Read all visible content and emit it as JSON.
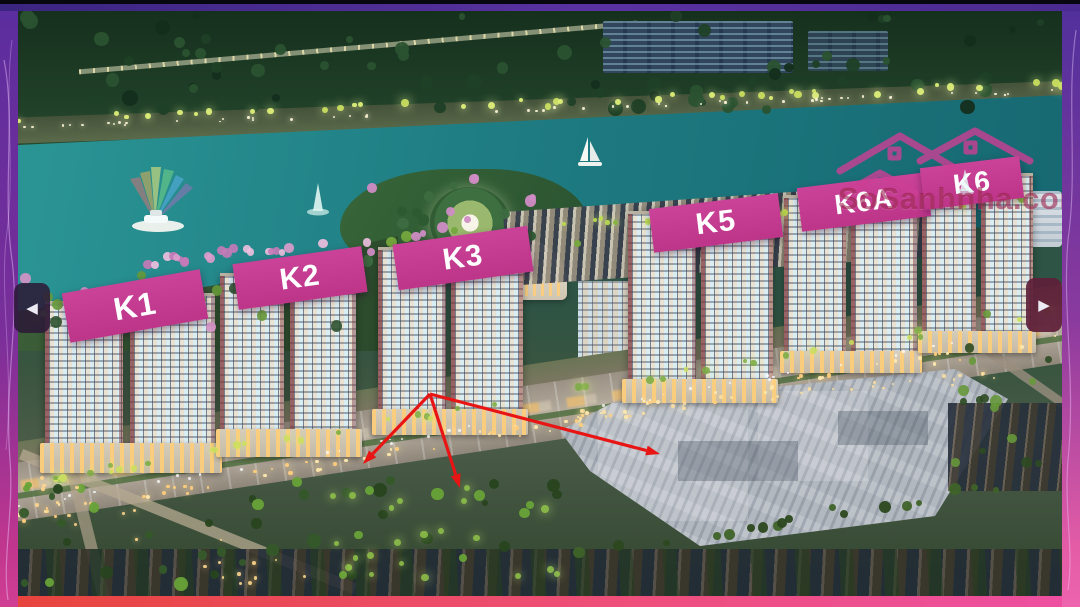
{
  "photo_overlay": {
    "building_labels": [
      {
        "name": "K1"
      },
      {
        "name": "K2"
      },
      {
        "name": "K3"
      },
      {
        "name": "K5"
      },
      {
        "name": "K6A"
      },
      {
        "name": "K6"
      }
    ],
    "watermark": {
      "brand": "SoSanhnha.com"
    },
    "annotation_colors": {
      "arrow": "#e81515",
      "label_background": "#c43d92",
      "watermark": "#96203f"
    }
  },
  "carousel": {
    "prev_icon": "◀",
    "next_icon": "▶"
  }
}
